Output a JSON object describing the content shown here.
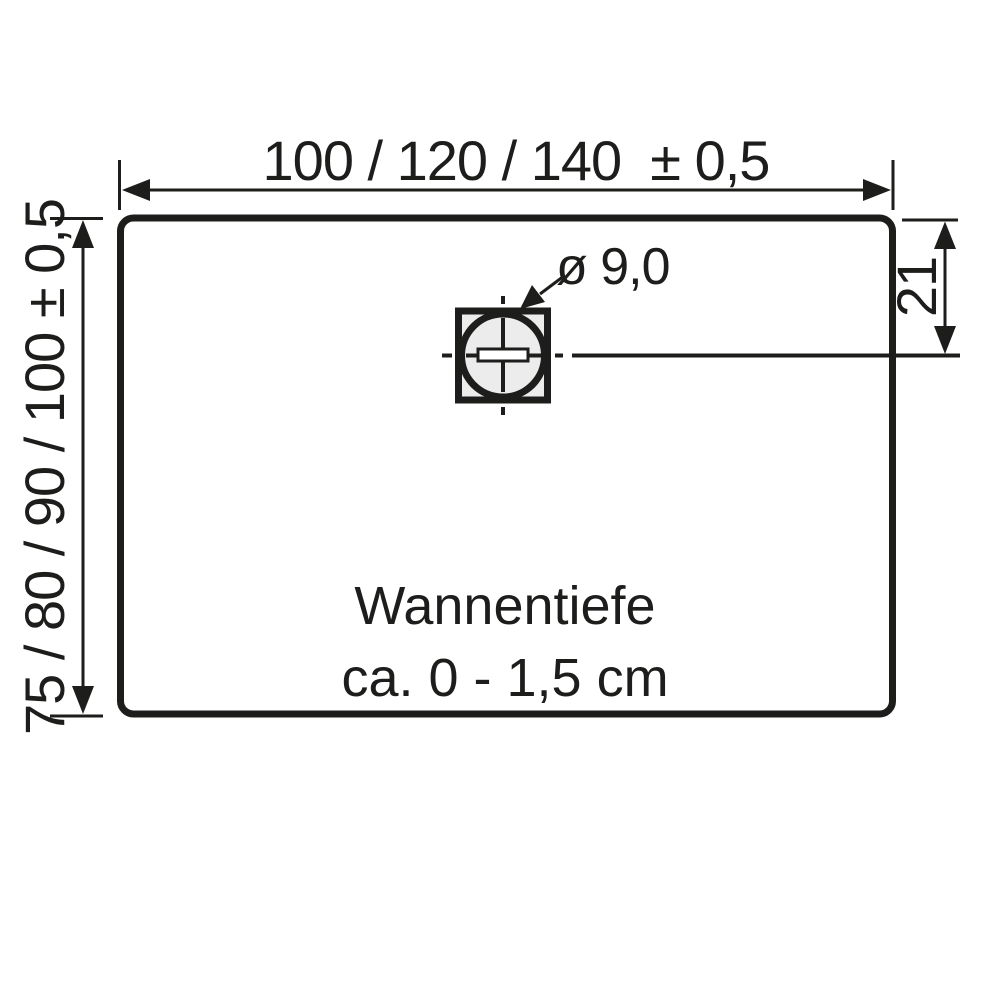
{
  "colors": {
    "line": "#1d1d1b",
    "background": "#ffffff",
    "drain_fill": "#ececec"
  },
  "diagram": {
    "type": "shower-tray-technical-drawing",
    "width_dimension": {
      "label": "100 / 120 / 140  ± 0,5",
      "values_cm": [
        100,
        120,
        140
      ],
      "tolerance": "± 0,5"
    },
    "height_dimension": {
      "label": "75 / 80 / 90 / 100 ± 0,5",
      "values_cm": [
        75,
        80,
        90,
        100
      ],
      "tolerance": "± 0,5"
    },
    "drain_offset_dimension": {
      "label": "21"
    },
    "drain_diameter_dimension": {
      "label": "ø 9,0"
    },
    "depth_note": {
      "line1": "Wannentiefe",
      "line2": "ca. 0 - 1,5 cm"
    }
  }
}
